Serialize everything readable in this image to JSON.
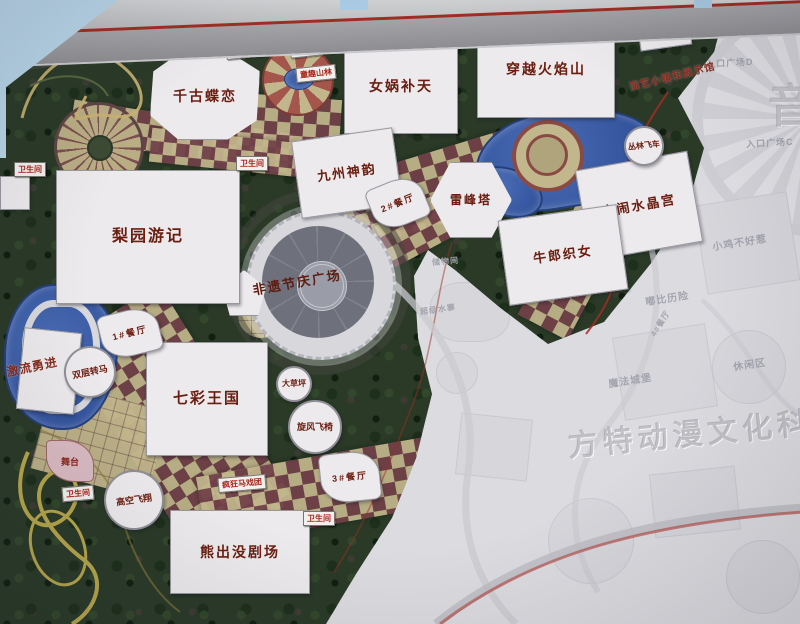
{
  "photo": {
    "watermark": "方特动漫文化科技",
    "edge_char": "音"
  },
  "colors": {
    "park_green": "#2a3a27",
    "path_maroon": "#714149",
    "path_tan": "#c2b68c",
    "water_blue": "#3c5ea6",
    "accent_red": "#a22d22",
    "ghost_gray": "#dcdce0",
    "label_dark_red": "#6b1d10",
    "sign_red": "#a82418",
    "sky_blue": "#b7d3e7"
  },
  "labels": {
    "buildings": [
      {
        "id": "qiangu-dielian",
        "text": "千古蝶恋",
        "x": 150,
        "y": 52,
        "w": 108,
        "h": 86,
        "fs": 14,
        "shape": "oct"
      },
      {
        "id": "nvwa-butian",
        "text": "女娲补天",
        "x": 344,
        "y": 38,
        "w": 112,
        "h": 94,
        "fs": 14,
        "shape": "rect"
      },
      {
        "id": "chuanyue-huoyanshan",
        "text": "穿越火焰山",
        "x": 477,
        "y": 20,
        "w": 136,
        "h": 96,
        "fs": 14,
        "shape": "rect"
      },
      {
        "id": "zongcang",
        "text": "总仓",
        "x": 638,
        "y": 12,
        "w": 50,
        "h": 34,
        "fs": 9,
        "rot": -8,
        "shape": "rect"
      },
      {
        "id": "jiuzhou-shenyun",
        "text": "九州神韵",
        "x": 296,
        "y": 134,
        "w": 100,
        "h": 76,
        "fs": 13,
        "rot": -8,
        "shape": "rect"
      },
      {
        "id": "leifeng-ta",
        "text": "雷峰塔",
        "x": 430,
        "y": 162,
        "w": 80,
        "h": 74,
        "fs": 12,
        "shape": "hex"
      },
      {
        "id": "danao-shuijinggong",
        "text": "大闹水晶宫",
        "x": 582,
        "y": 160,
        "w": 112,
        "h": 90,
        "fs": 13,
        "rot": -10,
        "shape": "rect"
      },
      {
        "id": "niulang-zhinv",
        "text": "牛郎织女",
        "x": 503,
        "y": 212,
        "w": 118,
        "h": 84,
        "fs": 13,
        "rot": -8,
        "shape": "rect"
      },
      {
        "id": "liyuan-youji",
        "text": "梨园游记",
        "x": 56,
        "y": 170,
        "w": 182,
        "h": 132,
        "fs": 16,
        "shape": "rect"
      },
      {
        "id": "qicai-wangguo",
        "text": "七彩王国",
        "x": 146,
        "y": 342,
        "w": 120,
        "h": 112,
        "fs": 15,
        "shape": "rect"
      },
      {
        "id": "xiongchumo-juchang",
        "text": "熊出没剧场",
        "x": 170,
        "y": 510,
        "w": 138,
        "h": 82,
        "fs": 14,
        "shape": "rect"
      },
      {
        "id": "restaurant-1",
        "text": "1#餐厅",
        "x": 100,
        "y": 310,
        "w": 58,
        "h": 44,
        "fs": 9,
        "rot": -14,
        "shape": "wedge"
      },
      {
        "id": "restaurant-2",
        "text": "2#餐厅",
        "x": 370,
        "y": 180,
        "w": 54,
        "h": 44,
        "fs": 9,
        "rot": -22,
        "shape": "wedge"
      },
      {
        "id": "restaurant-3",
        "text": "3#餐厅",
        "x": 320,
        "y": 452,
        "w": 58,
        "h": 48,
        "fs": 9,
        "rot": -6,
        "shape": "wedge"
      }
    ],
    "circles": [
      {
        "id": "dacaoping",
        "text": "大草坪",
        "x": 276,
        "y": 366,
        "d": 36,
        "fs": 8
      },
      {
        "id": "xuanfeng-feiyi",
        "text": "旋风飞椅",
        "x": 288,
        "y": 400,
        "d": 54,
        "fs": 9
      },
      {
        "id": "shuangceng-zhuanma",
        "text": "双层转马",
        "x": 64,
        "y": 346,
        "d": 52,
        "fs": 9,
        "rot": -12
      },
      {
        "id": "gaokong-feixiang",
        "text": "高空飞翔",
        "x": 104,
        "y": 470,
        "d": 60,
        "fs": 9,
        "rot": -8
      },
      {
        "id": "conglin-feiche",
        "text": "丛林飞车",
        "x": 624,
        "y": 126,
        "d": 40,
        "fs": 8,
        "rot": -6
      }
    ],
    "plaza": {
      "id": "feiyi-jieqing-guangchang",
      "text": "非遗节庆广场",
      "x": 252,
      "y": 272,
      "fs": 13,
      "rot": -10
    },
    "stage": {
      "id": "wutai",
      "text": "舞台",
      "x": 46,
      "y": 440,
      "w": 46,
      "h": 40,
      "fs": 9
    },
    "signs": [
      {
        "id": "chiller-room",
        "text": "制冷机房",
        "x": 226,
        "y": 43,
        "rot": -6
      },
      {
        "id": "power-room",
        "text": "配电房",
        "x": 290,
        "y": 42,
        "rot": -6
      },
      {
        "id": "tongqu-shanlin",
        "text": "童趣山林",
        "x": 296,
        "y": 66,
        "rot": -6
      },
      {
        "id": "fengkuang-maxituan",
        "text": "疯狂马戏团",
        "x": 218,
        "y": 476,
        "rot": -5
      },
      {
        "id": "wc-1",
        "text": "卫生间",
        "x": 14,
        "y": 162,
        "rot": 0
      },
      {
        "id": "wc-2",
        "text": "卫生间",
        "x": 236,
        "y": 156,
        "rot": 0
      },
      {
        "id": "wc-3",
        "text": "卫生间",
        "x": 62,
        "y": 486,
        "rot": -5
      },
      {
        "id": "wc-4",
        "text": "卫生间",
        "x": 303,
        "y": 511,
        "rot": 0
      }
    ],
    "area_labels": [
      {
        "id": "jiliu-yongjin",
        "text": "激流勇进",
        "x": 6,
        "y": 358,
        "rot": -12,
        "fs": 12
      },
      {
        "id": "yanyi-town",
        "text": "演艺小镇和展示馆",
        "x": 628,
        "y": 68,
        "rot": -14,
        "fs": 10
      }
    ],
    "ghost_labels": [
      {
        "id": "entrance-plaza-e",
        "text": "入口广场E",
        "x": 726,
        "y": 12,
        "rot": -5,
        "fs": 9
      },
      {
        "id": "entrance-plaza-d",
        "text": "入口广场D",
        "x": 706,
        "y": 56,
        "rot": -3,
        "fs": 9
      },
      {
        "id": "entrance-plaza-c",
        "text": "入口广场C",
        "x": 746,
        "y": 136,
        "rot": -3,
        "fs": 9
      },
      {
        "id": "xiaoji-buhaore",
        "text": "小鸡不好惹",
        "x": 712,
        "y": 234,
        "rot": -9,
        "fs": 10
      },
      {
        "id": "dubi-lixian",
        "text": "嘟比历险",
        "x": 645,
        "y": 290,
        "rot": -9,
        "fs": 10
      },
      {
        "id": "mofa-chengbao",
        "text": "魔法城堡",
        "x": 608,
        "y": 372,
        "rot": -9,
        "fs": 10
      },
      {
        "id": "xiuxian-qu",
        "text": "休闲区",
        "x": 733,
        "y": 356,
        "rot": -9,
        "fs": 10
      },
      {
        "id": "chuwujian",
        "text": "储物间",
        "x": 432,
        "y": 256,
        "rot": -5,
        "fs": 8
      },
      {
        "id": "restaurant-4",
        "text": "4#餐厅",
        "x": 646,
        "y": 318,
        "rot": -58,
        "fs": 8
      },
      {
        "id": "chaoji-shuizhai",
        "text": "超级水寨",
        "x": 420,
        "y": 304,
        "rot": -8,
        "fs": 8
      }
    ]
  }
}
